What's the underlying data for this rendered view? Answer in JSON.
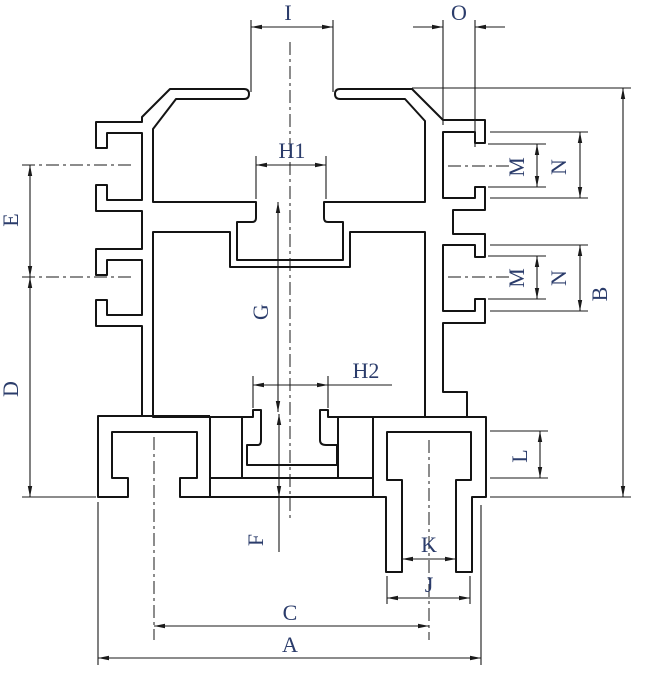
{
  "drawing": {
    "type": "extrusion-profile-cross-section",
    "background": "#ffffff",
    "line_color": "#141414",
    "label_color": "#2b3c6b"
  },
  "dimension_labels": {
    "A": "A",
    "B": "B",
    "C": "C",
    "D": "D",
    "E": "E",
    "F": "F",
    "G": "G",
    "H1": "H1",
    "H2": "H2",
    "I": "I",
    "J": "J",
    "K": "K",
    "L": "L",
    "M": "M",
    "N": "N",
    "O": "O"
  }
}
